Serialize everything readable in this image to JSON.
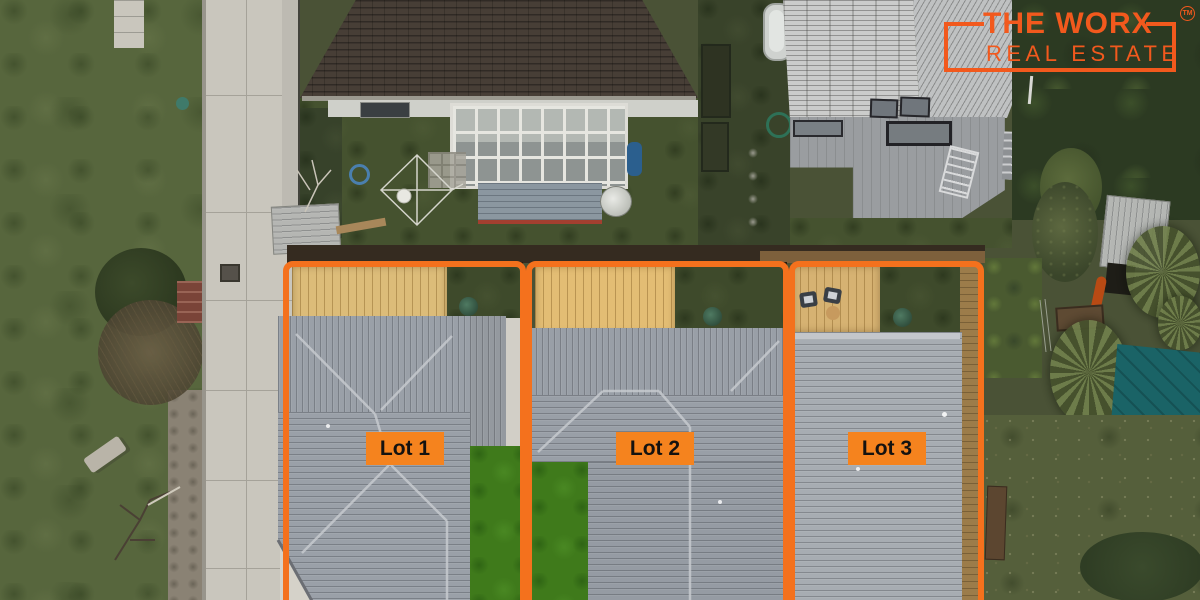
{
  "brand": {
    "line1": "THE WORX",
    "line2": "REAL ESTATE",
    "trademark": "TM"
  },
  "lots": [
    {
      "label": "Lot 1"
    },
    {
      "label": "Lot 2"
    },
    {
      "label": "Lot 3"
    }
  ],
  "colors": {
    "boundary_orange": "#f4711d",
    "label_orange": "#f5831e",
    "logo_orange": "#f2591d",
    "label_text": "#141210",
    "tarp_teal": "#1a6366"
  }
}
